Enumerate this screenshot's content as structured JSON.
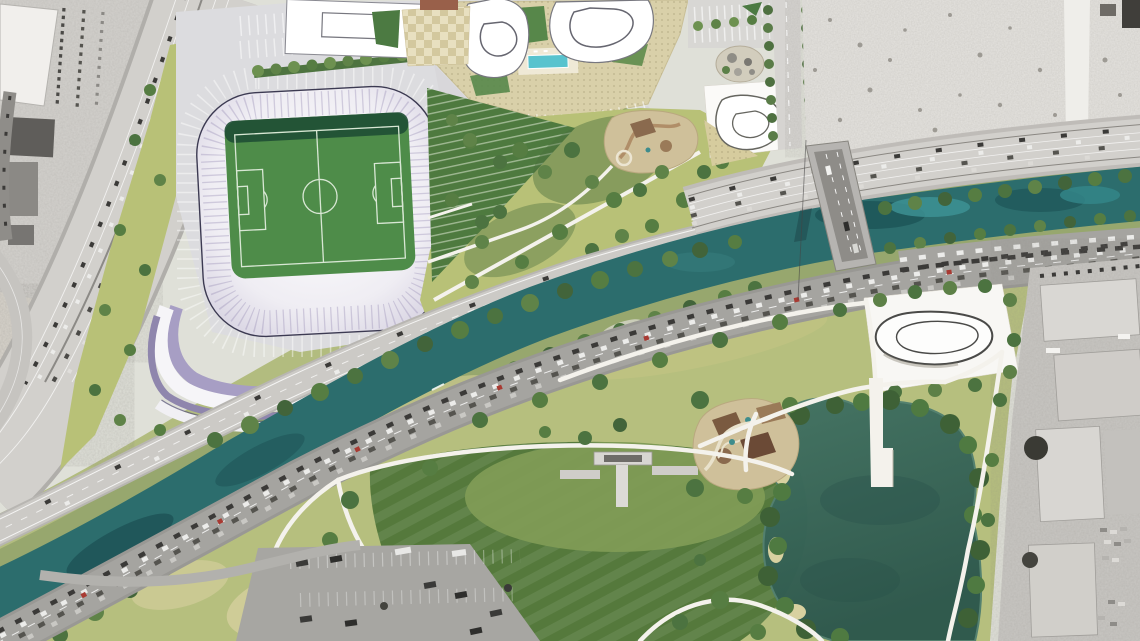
{
  "scene": {
    "kind": "aerial-site-plan-rendering",
    "features": {
      "stadium": "soccer-stadium-with-lavender-roof",
      "campus": "mixed-use-buildings-with-pool-podium",
      "river": "diagonal-river-corridor",
      "bridge": "road-bridge-over-river",
      "park": "riverfront-park-with-lake-and-pier",
      "context": "grayscale-existing-aerial"
    }
  },
  "colors": {
    "bg": "#dfe0d8",
    "aerial_tl": "#d4d2ce",
    "aerial_vacant": "#e6e4e0",
    "industrial_e": "#c9c7c3",
    "rocky": "#d7d3cb",
    "road_freeway": "#d2d0cc",
    "road_light": "#cccac6",
    "road_arterial": "#a5a4a0",
    "bridge": "#b6b4b1",
    "plaza": "#dcdcdf",
    "podium": "#d9d0a9",
    "pool": "#58c3ce",
    "building_white": "#ffffff",
    "roof_white": "#f6f5f8",
    "roof_lavender": "#a79ec4",
    "roof_lavender_dark": "#8f86ad",
    "roof_outline": "#3c3a52",
    "pitch": "#4e8c49",
    "pitch_shadow": "#1f4e34",
    "field_line": "#d8e7d4",
    "corridor_green": "#b2bc7f",
    "hillside": "#b8c177",
    "terrace_green": "#4e7a3f",
    "lawn_dark": "#55793c",
    "lawn_light": "#7f9b55",
    "scrub": "#d7d0a0",
    "playground": "#cfc09a",
    "tree": "#5f8348",
    "tree_dark": "#42643a",
    "river": "#2c6d6d",
    "river_deep": "#174c50",
    "river_light": "#3f9496",
    "lake_top": "#437363",
    "lake_bottom": "#2e584d",
    "path": "#f4f2ec",
    "parcel_white": "#f8f7f4",
    "street": "#d6d4d1",
    "car_dark": "#3b3a38",
    "car_white": "#ececea",
    "car_red": "#a83a32"
  }
}
